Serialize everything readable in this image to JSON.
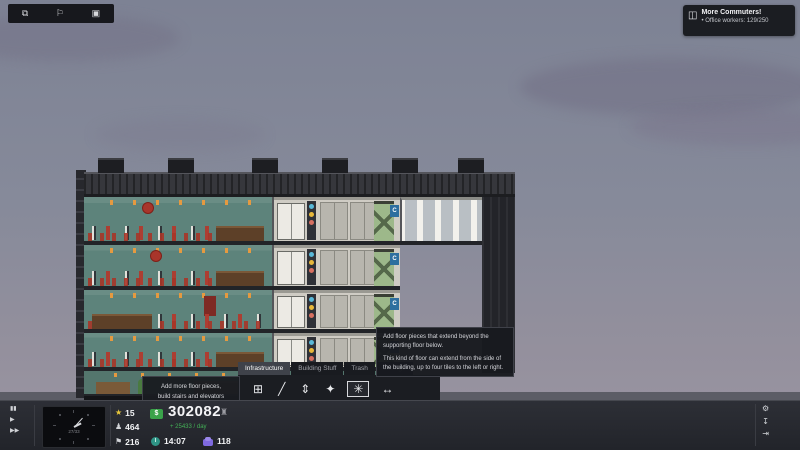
{
  "topbar": {
    "icons": [
      "⧉",
      "⚐",
      "▣"
    ]
  },
  "notification": {
    "icon": "◫",
    "title": "More Commuters!",
    "bullet": "•",
    "body": "Office workers: 129/250"
  },
  "building": {
    "elevator_label": "C"
  },
  "build_panel": {
    "tabs": [
      "Infrastructure",
      "Building Stuff",
      "Trash",
      "Storage"
    ],
    "active_tab": "Infrastructure",
    "tools": [
      "⊞",
      "╱",
      "⇕",
      "✦",
      "✳",
      "↔"
    ],
    "selected_tool": "extended-floor"
  },
  "tooltips": {
    "left": {
      "line1": "Add more floor pieces,",
      "line2": "build stairs and elevators"
    },
    "right": {
      "p1": "Add floor pieces that extend beyond the supporting floor below.",
      "p2": "This kind of floor can extend from the side of the building, up to four tiles to the left or right."
    }
  },
  "toolbar": {
    "speed": {
      "pause": "▮▮",
      "play": "▶",
      "ffwd": "▶▶"
    },
    "clock_day": "27/33",
    "stats": {
      "star_icon": "★",
      "stars": "15",
      "person_icon": "♟",
      "population": "464",
      "visitor_icon": "⚑",
      "visitors": "216",
      "currency": "$",
      "money": "302082",
      "bank_icon": "♜",
      "income": "+ 25433 / day",
      "time": "14:07",
      "contacts": "118"
    },
    "menu": {
      "row1": [
        "⚒",
        "⚡",
        "⌨",
        "⌂",
        "▣",
        "⚭",
        "▤"
      ],
      "row2": [
        "♜",
        "✳",
        "Ψ",
        "",
        "✎",
        "",
        "≣"
      ]
    },
    "system": {
      "settings": "⚙",
      "save": "↧",
      "exit": "⇥"
    }
  },
  "colors": {
    "accent_orange": "#d99a3c",
    "money_green": "#3aa34a",
    "star_yellow": "#e9c83b",
    "contact_purple": "#7f6ae0",
    "wall_teal": "#5d837b",
    "chair_red": "#b23a2e",
    "sky": "#868a9a"
  }
}
